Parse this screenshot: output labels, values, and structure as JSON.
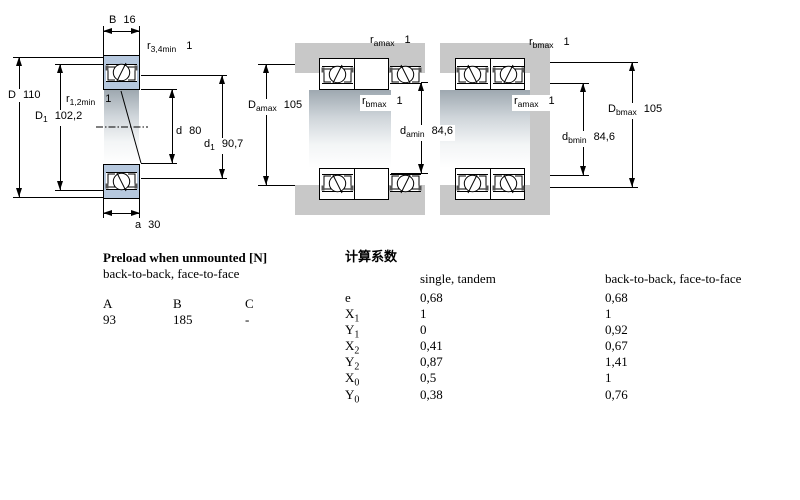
{
  "drawing": {
    "single": {
      "b_dim": {
        "letter": "B",
        "value": "16"
      },
      "r34": {
        "letter": "r",
        "sub": "3,4min",
        "fn": "1"
      },
      "r12": {
        "letter": "r",
        "sub": "1,2min",
        "fn": "1"
      },
      "D": {
        "letter": "D",
        "value": "110"
      },
      "D1": {
        "letter": "D",
        "sub": "1",
        "value": "102,2"
      },
      "d": {
        "letter": "d",
        "value": "80"
      },
      "d1": {
        "letter": "d",
        "sub": "1",
        "value": "90,7"
      },
      "a_dim": {
        "letter": "a",
        "value": "30"
      }
    },
    "back_to_back": {
      "ra": {
        "letter": "r",
        "sub": "amax",
        "fn": "1"
      },
      "rb": {
        "letter": "r",
        "sub": "bmax",
        "fn": "1"
      },
      "Da": {
        "letter": "D",
        "sub": "amax",
        "value": "105"
      },
      "da": {
        "letter": "d",
        "sub": "amin",
        "value": "84,6"
      }
    },
    "face_to_face": {
      "rb": {
        "letter": "r",
        "sub": "bmax",
        "fn": "1"
      },
      "ra": {
        "letter": "r",
        "sub": "amax",
        "fn": "1"
      },
      "db": {
        "letter": "d",
        "sub": "bmin",
        "value": "84,6"
      },
      "Db": {
        "letter": "D",
        "sub": "bmax",
        "value": "105"
      }
    },
    "colors": {
      "ring_blue": "#b6c8de",
      "housing_gray": "#c8c8c8"
    }
  },
  "preload_table": {
    "title": "Preload when unmounted [N]",
    "subtitle": "back-to-back, face-to-face",
    "columns": [
      "A",
      "B",
      "C"
    ],
    "values": [
      "93",
      "185",
      "-"
    ]
  },
  "factors_table": {
    "title": "计算系数",
    "col_single": "single, tandem",
    "col_paired": "back-to-back, face-to-face",
    "rows": [
      {
        "symbol": "e",
        "sub": "",
        "single": "0,68",
        "paired": "0,68"
      },
      {
        "symbol": "X",
        "sub": "1",
        "single": "1",
        "paired": "1"
      },
      {
        "symbol": "Y",
        "sub": "1",
        "single": "0",
        "paired": "0,92"
      },
      {
        "symbol": "X",
        "sub": "2",
        "single": "0,41",
        "paired": "0,67"
      },
      {
        "symbol": "Y",
        "sub": "2",
        "single": "0,87",
        "paired": "1,41"
      },
      {
        "symbol": "X",
        "sub": "0",
        "single": "0,5",
        "paired": "1"
      },
      {
        "symbol": "Y",
        "sub": "0",
        "single": "0,38",
        "paired": "0,76"
      }
    ]
  }
}
